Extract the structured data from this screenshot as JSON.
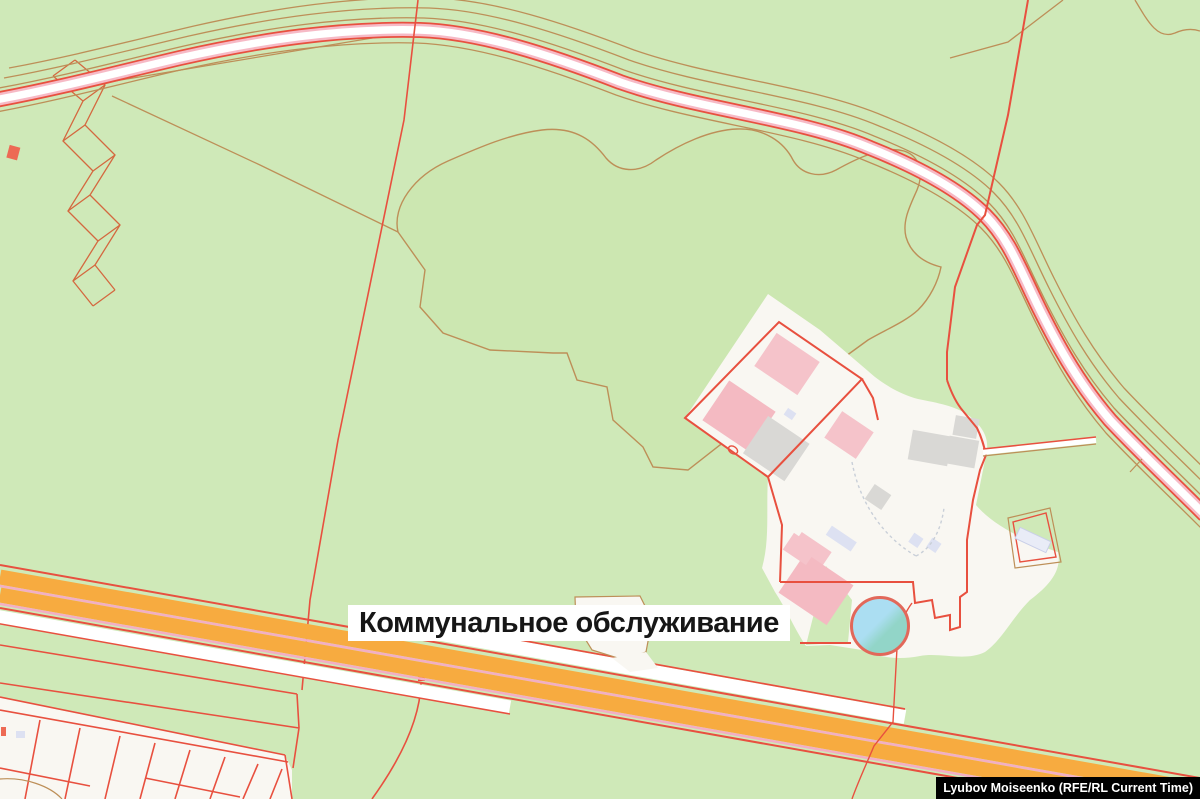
{
  "map": {
    "style": "cadastral-parcel-overlay-map",
    "poi_label": {
      "text": "Коммунальное обслуживание",
      "text_color": "#161616",
      "box_color": "#ffffff"
    },
    "poi_marker": {
      "icon": "circle-marker",
      "fill_light": "#abdef2",
      "fill_dark": "#92d5c8",
      "border_color": "#e2685a"
    },
    "credit_badge": {
      "text": "Lyubov Moiseenko (RFE/RL Current Time)",
      "text_color": "#ffffff",
      "background_color": "#000000"
    },
    "palette": {
      "land": "#cfe9b8",
      "woodland": "#cce7b1",
      "built_area": "#f9f7f2",
      "cadastral_line": "#e8503f",
      "landuse_line": "#bd8f58",
      "motorway_fill": "#f7ab40",
      "motorway_stripe": "#f3aec4",
      "road_fill": "#ffffff",
      "road_stripe": "#f6bac6",
      "building_pink": "#f5c3ca",
      "building_gray": "#d9d8d5",
      "building_lavender": "#dde1f2"
    }
  }
}
